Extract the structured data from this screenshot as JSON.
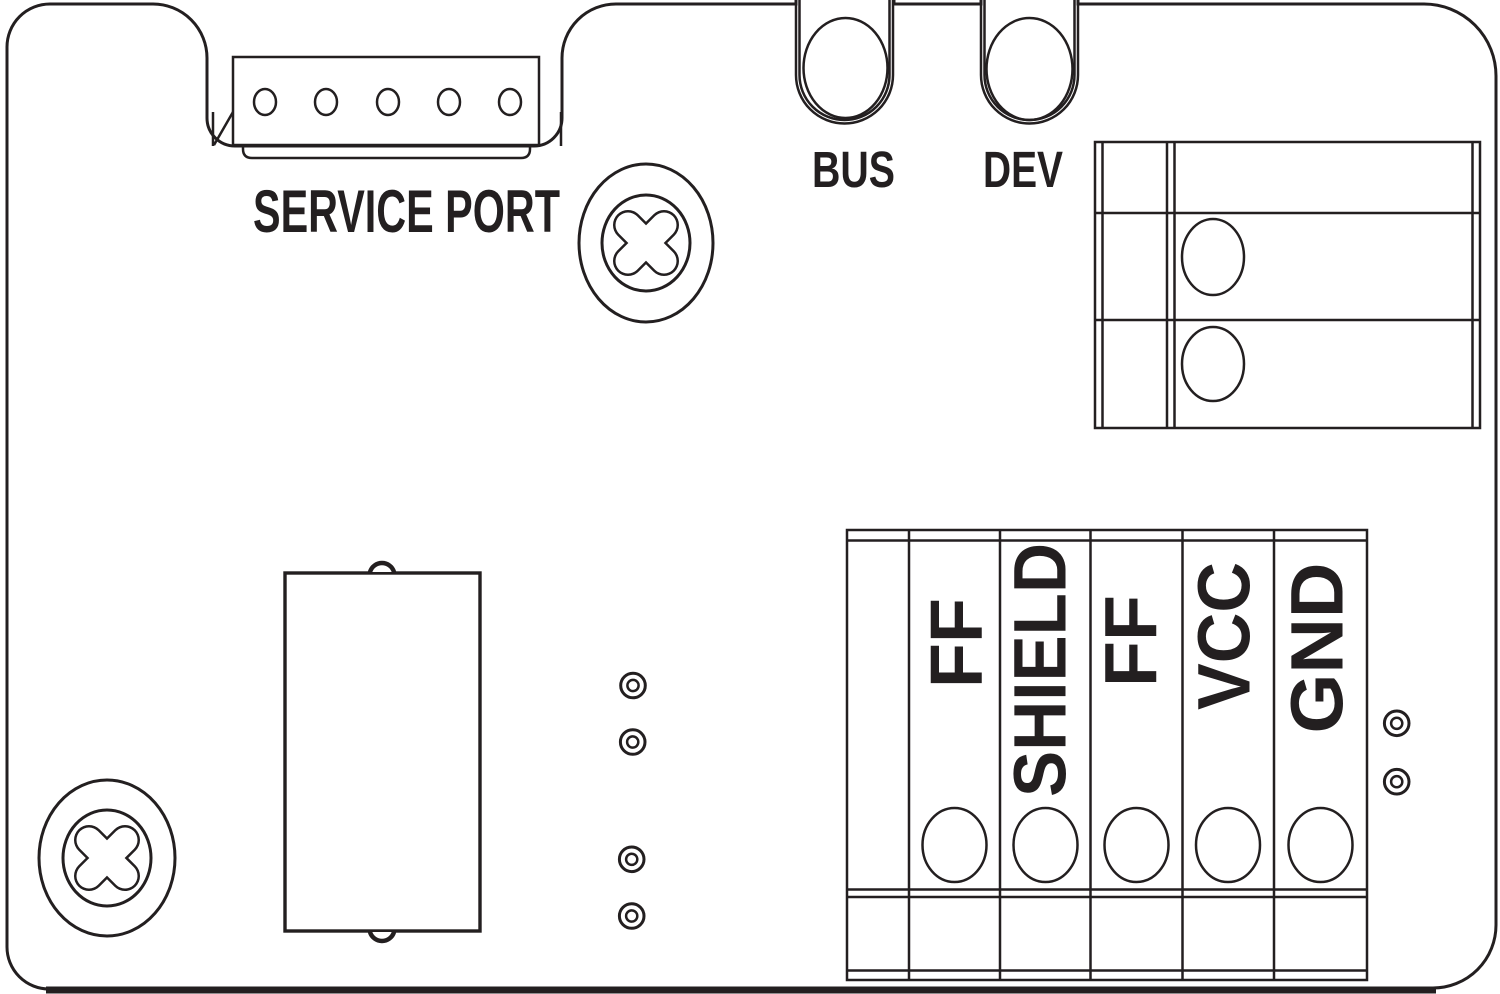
{
  "palette": {
    "ink": "#231f20",
    "paper": "#ffffff"
  },
  "board": {
    "service_port": {
      "label": "SERVICE PORT",
      "pin_holes": 5
    },
    "status_leds": {
      "bus": "BUS",
      "dev": "DEV"
    },
    "connector_block": {
      "rows": 3,
      "holes": 2
    },
    "terminal_block": {
      "labels": {
        "pin1": "FF",
        "pin2": "SHIELD",
        "pin3": "FF",
        "pin4": "VCC",
        "pin5": "GND"
      },
      "wire_entries": 5
    },
    "screws": 2,
    "test_points": 6
  }
}
